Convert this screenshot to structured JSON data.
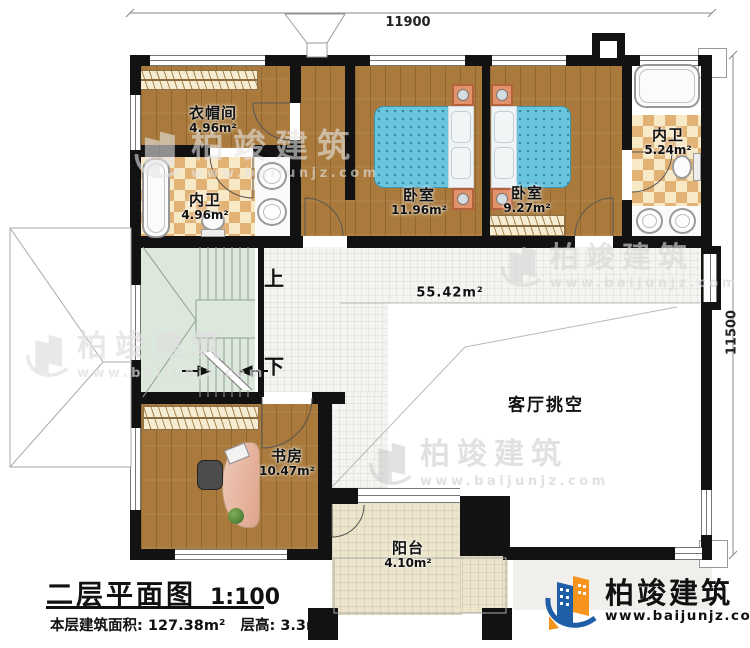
{
  "title_block": {
    "plan_name": "二层平面图",
    "scale": "1:100",
    "area_label": "本层建筑面积:",
    "area_value": "127.38m²",
    "floor_height_label": "层高:",
    "floor_height_value": "3.3m"
  },
  "dimensions": {
    "top": "11900",
    "right": "11500"
  },
  "rooms": {
    "cloakroom": {
      "name": "衣帽间",
      "area": "4.96m²"
    },
    "bath1": {
      "name": "内卫",
      "area": "4.96m²"
    },
    "bedroom1": {
      "name": "卧室",
      "area": "11.96m²"
    },
    "bedroom2": {
      "name": "卧室",
      "area": "9.27m²"
    },
    "bath2": {
      "name": "内卫",
      "area": "5.24m²"
    },
    "study": {
      "name": "书房",
      "area": "10.47m²"
    },
    "balcony": {
      "name": "阳台",
      "area": "4.10m²"
    },
    "hall": {
      "area": "55.42m²"
    },
    "living_void": {
      "name": "客厅挑空"
    }
  },
  "stairs": {
    "up_label": "上",
    "down_label": "下"
  },
  "watermark": {
    "brand": "柏竣建筑",
    "url": "www.baijunjz.com"
  },
  "logo": {
    "brand": "柏竣建筑",
    "url": "www.baijunjz.com"
  },
  "colors": {
    "wall": "#121212",
    "wood": "#a97a3c",
    "chk-a": "#e2b274",
    "chk-b": "#f7e9c6",
    "tile": "#f4f4f1",
    "btile": "#ece5cb",
    "stairs": "#dde8dc",
    "bed": "#69c4dd",
    "logo-blue": "#1e5fa8",
    "logo-orange": "#f7941d"
  }
}
